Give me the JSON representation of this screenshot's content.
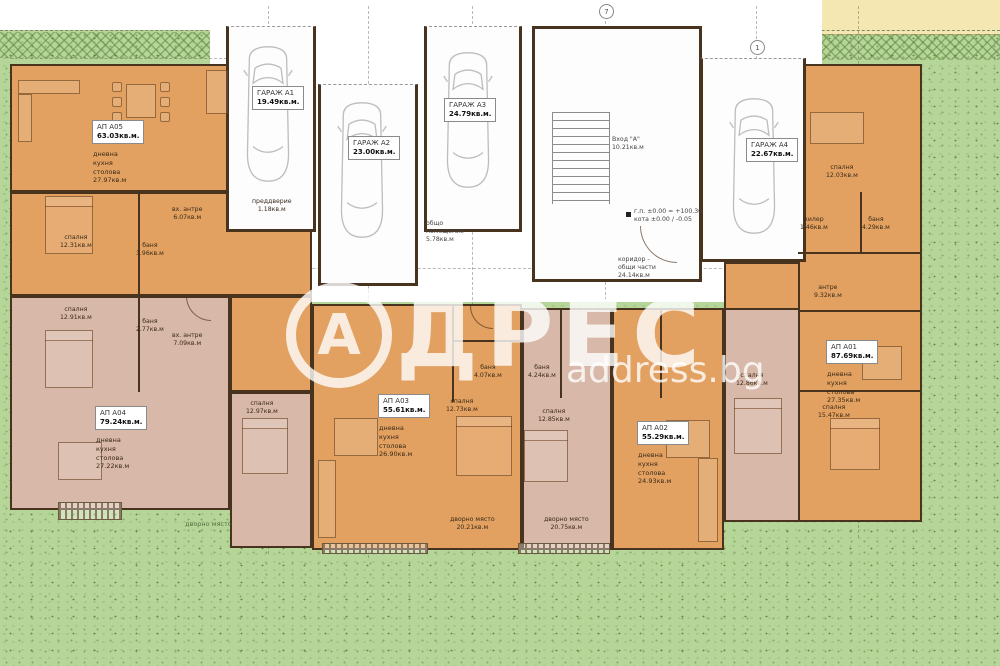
{
  "watermark": {
    "letter": "А",
    "rest": "ДРЕС",
    "domain": "address.bg"
  },
  "axes": {
    "a": "7",
    "b": "1"
  },
  "colors": {
    "apartment_orange": "#e2a161",
    "apartment_pink": "#d8b8a8",
    "grass_green": "#b6d599",
    "neighbor_yellow": "#f5e7b2",
    "wall_brown": "#47331e"
  },
  "garages": [
    {
      "name": "ГАРАЖ А1",
      "area": "19.49кв.м."
    },
    {
      "name": "ГАРАЖ А2",
      "area": "23.00кв.м."
    },
    {
      "name": "ГАРАЖ А3",
      "area": "24.79кв.м."
    },
    {
      "name": "ГАРАЖ А4",
      "area": "22.67кв.м."
    }
  ],
  "apartments": [
    {
      "name": "АП А05",
      "area": "63.03кв.м.",
      "l1": "дневна",
      "l2": "кухня",
      "l3": "столова",
      "room_area": "27.97кв.м"
    },
    {
      "name": "АП А04",
      "area": "79.24кв.м.",
      "l1": "дневна",
      "l2": "кухня",
      "l3": "столова",
      "room_area": "27.22кв.м"
    },
    {
      "name": "АП А03",
      "area": "55.61кв.м.",
      "l1": "дневна",
      "l2": "кухня",
      "l3": "столова",
      "room_area": "26.90кв.м"
    },
    {
      "name": "АП А02",
      "area": "55.29кв.м.",
      "l1": "дневна",
      "l2": "кухня",
      "l3": "столова",
      "room_area": "24.93кв.м"
    },
    {
      "name": "АП А01",
      "area": "87.69кв.м.",
      "l1": "дневна",
      "l2": "кухня",
      "l3": "столова",
      "room_area": "27.35кв.м"
    }
  ],
  "common": {
    "entrance": "Вход \"А\"",
    "entrance_area": "10.21кв.м",
    "corridor1": "коридор -",
    "corridor2": "общи части",
    "corridor_area": "24.14кв.м",
    "storage1": "общо",
    "storage2": "помещение",
    "storage_area": "5.78кв.м",
    "vestibule": "преддверие",
    "vestibule_area": "1.18кв.м",
    "elev1": "г.п. ±0.00 = +100.30",
    "elev2": "кота ±0.00 / -0.05"
  },
  "rooms": [
    {
      "label": "спалня",
      "area": "12.31кв.м"
    },
    {
      "label": "баня",
      "area": "3.96кв.м"
    },
    {
      "label": "вх. антре",
      "area": "6.07кв.м"
    },
    {
      "label": "спалня",
      "area": "12.91кв.м"
    },
    {
      "label": "баня",
      "area": "2.77кв.м"
    },
    {
      "label": "вх. антре",
      "area": "7.09кв.м"
    },
    {
      "label": "спалня",
      "area": "12.97кв.м"
    },
    {
      "label": "спалня",
      "area": "12.73кв.м"
    },
    {
      "label": "баня",
      "area": "4.07кв.м"
    },
    {
      "label": "дворно място",
      "area": "20.21кв.м"
    },
    {
      "label": "спалня",
      "area": "12.85кв.м"
    },
    {
      "label": "баня",
      "area": "4.24кв.м"
    },
    {
      "label": "дворно място",
      "area": "20.75кв.м"
    },
    {
      "label": "спалня",
      "area": "12.86кв.м"
    },
    {
      "label": "спалня",
      "area": "12.03кв.м"
    },
    {
      "label": "килер",
      "area": "1.46кв.м"
    },
    {
      "label": "баня",
      "area": "4.29кв.м"
    },
    {
      "label": "антре",
      "area": "9.32кв.м"
    },
    {
      "label": "спалня",
      "area": "15.47кв.м"
    }
  ],
  "yard": {
    "label": "дворно място"
  }
}
